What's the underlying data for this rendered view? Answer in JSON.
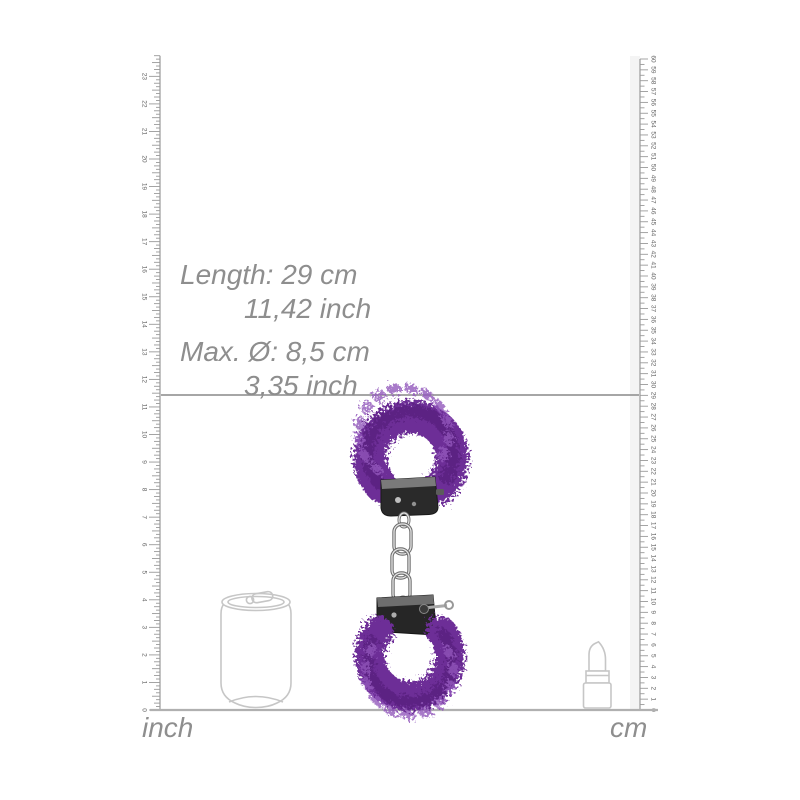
{
  "page": {
    "type": "product-dimension-diagram",
    "background": "#ffffff"
  },
  "annotations": {
    "length_cm": "Length: 29 cm",
    "length_inch": "11,42 inch",
    "diameter_cm": "Max. Ø: 8,5 cm",
    "diameter_inch": "3,35 inch"
  },
  "measurement": {
    "length_cm": 29,
    "length_inch": 11.42,
    "max_diameter_cm": 8.5,
    "max_diameter_inch": 3.35
  },
  "rulers": {
    "baseline_y": 710,
    "left": {
      "label": "inch",
      "min": 0,
      "max": 23,
      "px_per_unit": 27.55,
      "number_every": 1,
      "side": "left",
      "x": 160
    },
    "right": {
      "label": "cm",
      "min": 0,
      "max": 60,
      "px_per_unit": 10.85,
      "number_every": 1,
      "side": "right",
      "x": 640
    }
  },
  "objects": {
    "product": "purple-furry-handcuffs",
    "reference_left": "soda-can-outline",
    "reference_right": "lipstick-outline"
  },
  "colors": {
    "annotation_text": "#8e8e8e",
    "ruler_line": "#9a9a9a",
    "tick_label": "#636363",
    "length_line": "#9a9a9a",
    "baseline": "#b0b0b0",
    "fur_purple": "#6d2d97",
    "fur_dark": "#551f7c",
    "fur_light": "#9257bb",
    "metal_dark": "#2a2a2a",
    "metal_band": "#7a7a7a",
    "chain_silver": "#8f8f8f",
    "reference_outline": "#c6c6c6"
  }
}
